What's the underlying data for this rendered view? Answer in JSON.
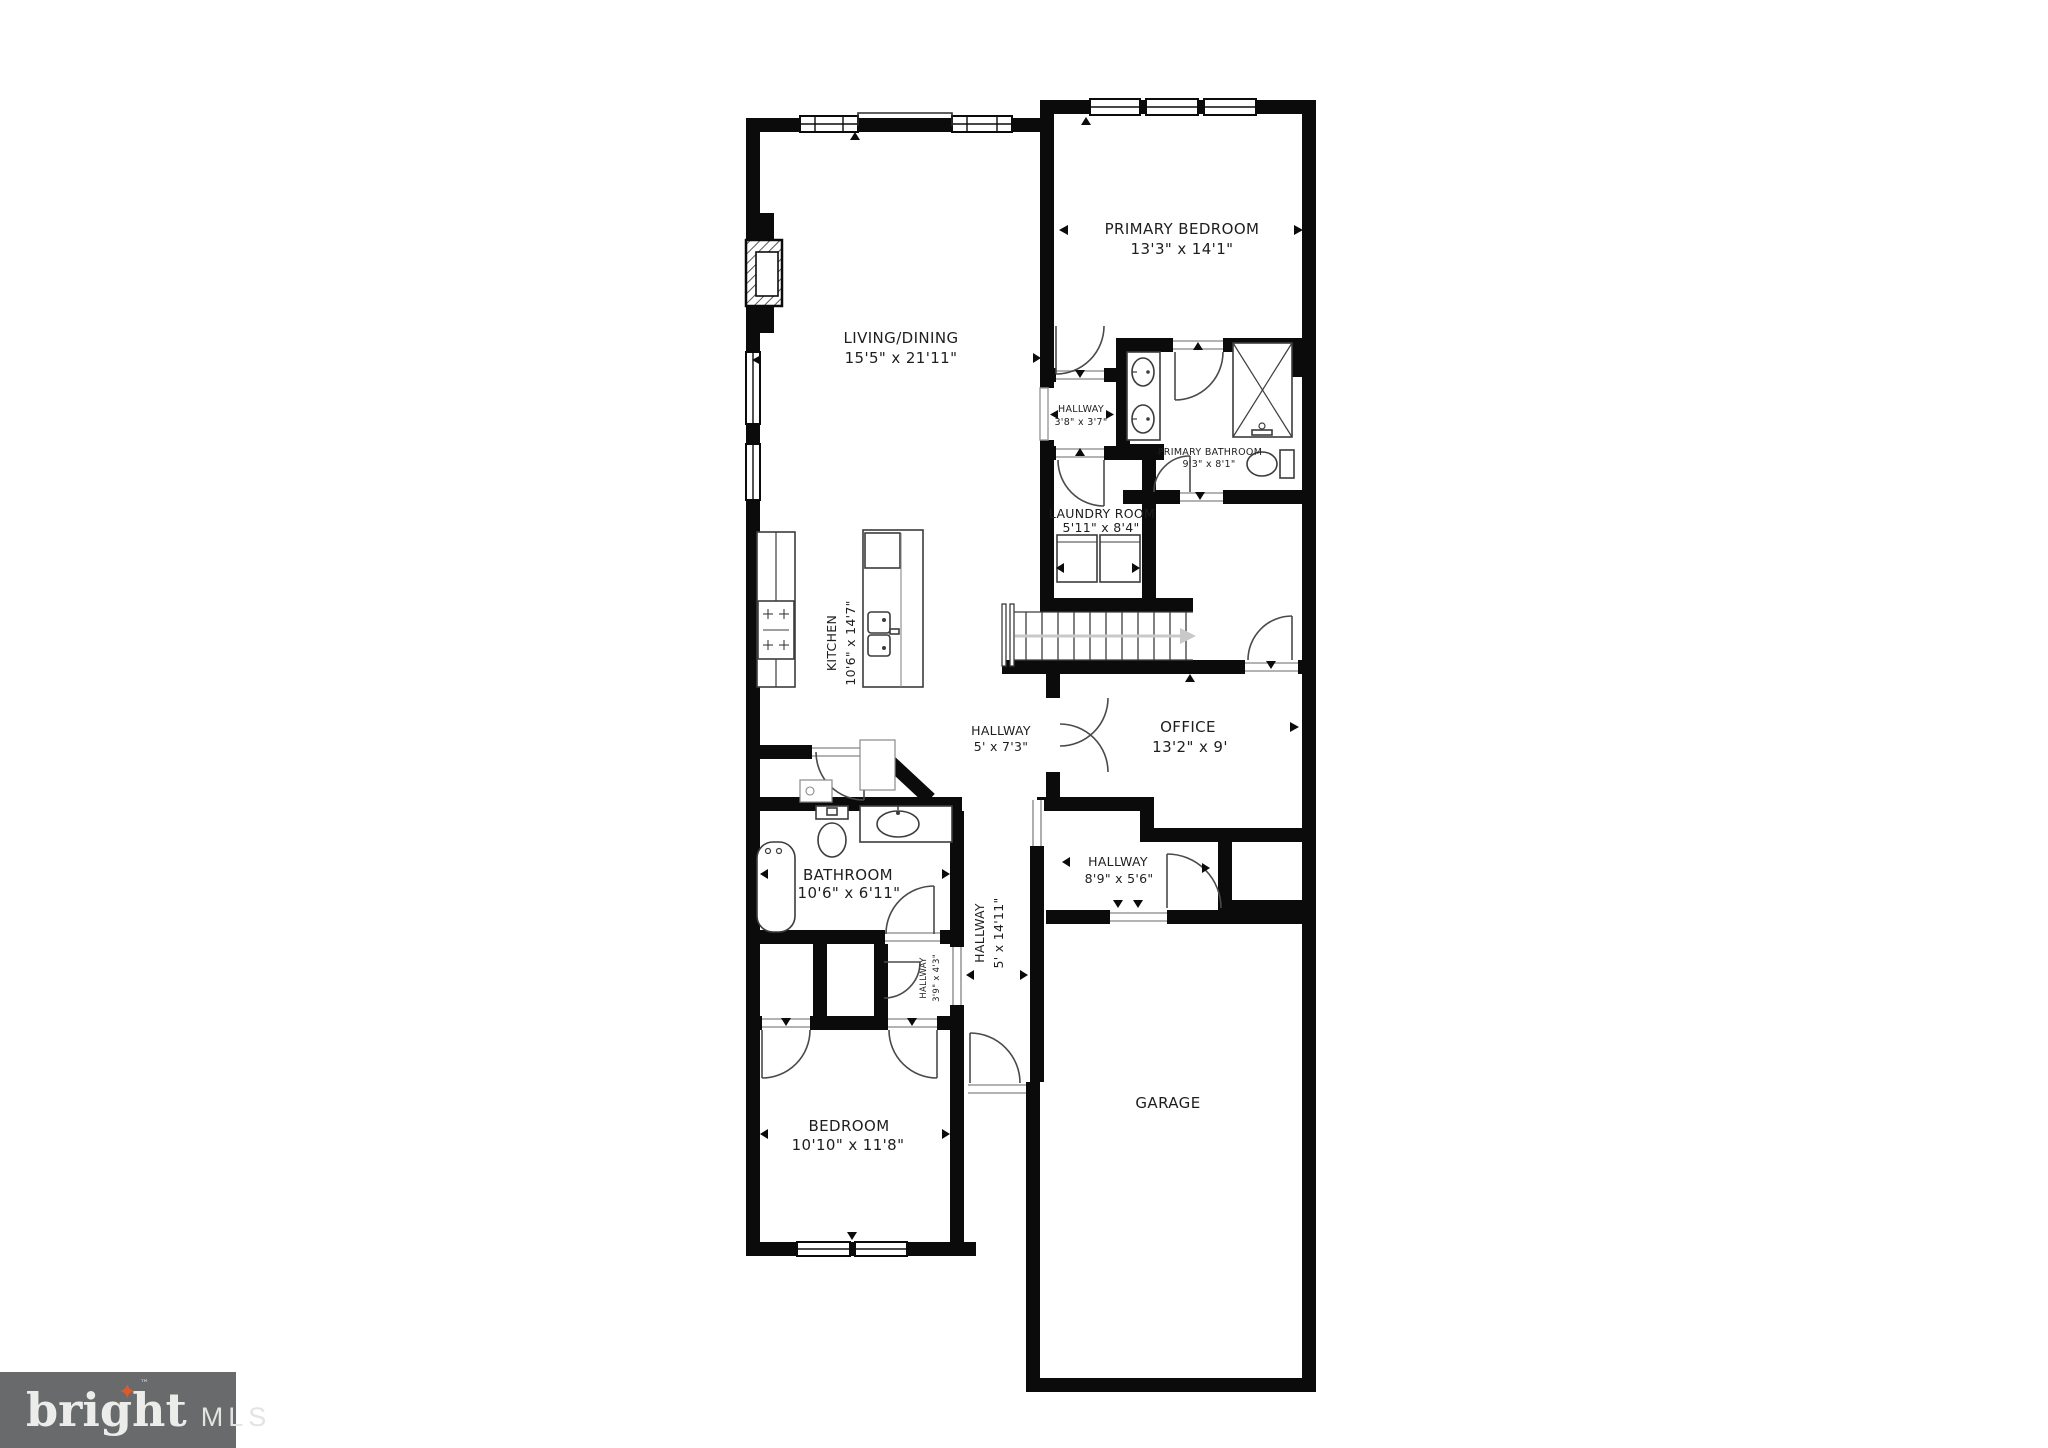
{
  "branding": {
    "logo_text": "bright",
    "logo_tm": "™",
    "logo_mls": "MLS",
    "colors": {
      "logo_bg": "#696a6c",
      "logo_text": "#ececea",
      "logo_star": "#dd5a2c"
    }
  },
  "plan": {
    "wall_color": "#0b0b0b",
    "label_color": "#1e1e1e",
    "stair_arrow_color": "#c9c9c9"
  },
  "rooms": {
    "living_dining": {
      "name": "LIVING/DINING",
      "dims": "15'5\" x 21'11\""
    },
    "primary_bedroom": {
      "name": "PRIMARY BEDROOM",
      "dims": "13'3\" x 14'1\""
    },
    "hallway_upper": {
      "name": "HALLWAY",
      "dims": "3'8\" x 3'7\""
    },
    "primary_bathroom": {
      "name": "PRIMARY BATHROOM",
      "dims": "9'3\" x 8'1\""
    },
    "laundry_room": {
      "name": "LAUNDRY ROOM",
      "dims": "5'11\" x 8'4\""
    },
    "kitchen": {
      "name": "KITCHEN",
      "dims": "10'6\" x 14'7\""
    },
    "hallway_center": {
      "name": "HALLWAY",
      "dims": "5' x 7'3\""
    },
    "office": {
      "name": "OFFICE",
      "dims": "13'2\" x 9'"
    },
    "bathroom": {
      "name": "BATHROOM",
      "dims": "10'6\" x 6'11\""
    },
    "hallway_side": {
      "name": "HALLWAY",
      "dims": "8'9\" x 5'6\""
    },
    "hallway_long": {
      "name": "HALLWAY",
      "dims": "5' x 14'11\""
    },
    "hallway_small": {
      "name": "HALLWAY",
      "dims": "3'9\" x 4'3\""
    },
    "bedroom": {
      "name": "BEDROOM",
      "dims": "10'10\" x 11'8\""
    },
    "garage": {
      "name": "GARAGE",
      "dims": ""
    }
  }
}
